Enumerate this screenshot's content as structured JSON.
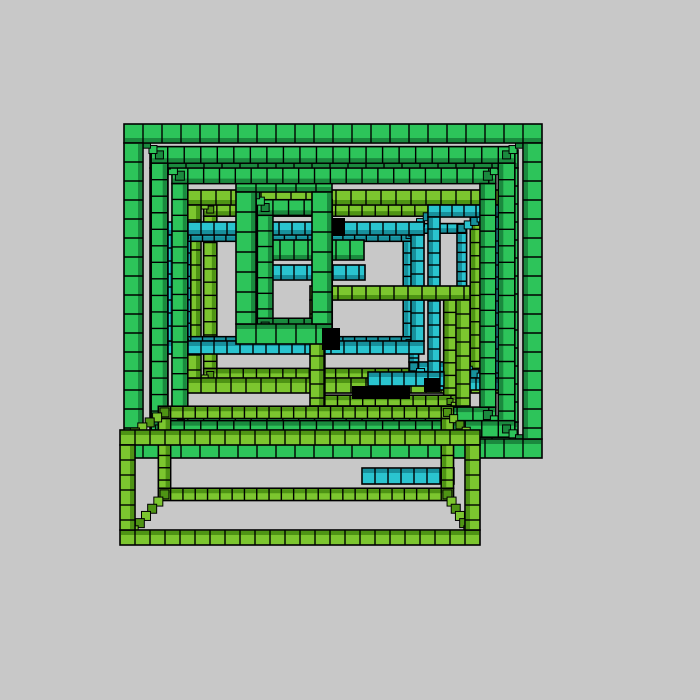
{
  "canvas": {
    "width": 700,
    "height": 700,
    "background": "#c8c8c8",
    "outline": "#000000"
  },
  "projection": {
    "vanishing_point": [
      333,
      298
    ]
  },
  "palette": {
    "green": {
      "fill": "#2dc45a",
      "dark": "#1a8a3e"
    },
    "lime": {
      "fill": "#7cc62f",
      "dark": "#4e9414"
    },
    "cyan": {
      "fill": "#2ac4cf",
      "dark": "#17909c"
    },
    "shadow": "#000000"
  },
  "scene": {
    "description": "nested voxel wireframe cubes",
    "items": [
      {
        "type": "frame",
        "name": "lime-cube-large",
        "color": "lime",
        "front": [
          186,
          190,
          318,
          203
        ],
        "k": 0.88,
        "block": 15
      },
      {
        "type": "frame",
        "name": "cyan-cube-right",
        "color": "cyan",
        "front": [
          428,
          205,
          72,
          185
        ],
        "k": 0.8,
        "block": 12
      },
      {
        "type": "frame",
        "name": "cyan-cube-left",
        "color": "cyan",
        "front": [
          162,
          222,
          262,
          132
        ],
        "k": 0.9,
        "block": 13
      },
      {
        "type": "frame",
        "name": "lime-cube-right",
        "color": "lime",
        "front": [
          310,
          286,
          160,
          134
        ],
        "k": 0.9,
        "block": 14
      },
      {
        "type": "beam",
        "name": "green-beam-upper",
        "color": "green",
        "rect": [
          252,
          240,
          112,
          20
        ],
        "block": 14
      },
      {
        "type": "beam",
        "name": "cyan-beam-mid",
        "color": "cyan",
        "rect": [
          255,
          265,
          110,
          15
        ],
        "block": 13
      },
      {
        "type": "beam",
        "name": "cyan-beam-lower",
        "color": "cyan",
        "rect": [
          368,
          372,
          76,
          14
        ],
        "block": 12
      },
      {
        "type": "frame",
        "name": "green-cube-center",
        "color": "green",
        "front": [
          236,
          172,
          96,
          172
        ],
        "k": 0.78,
        "block": 20
      },
      {
        "type": "shadow",
        "name": "shadow-center",
        "rect": [
          322,
          328,
          18,
          22
        ]
      },
      {
        "type": "shadow",
        "name": "shadow-lower-left",
        "rect": [
          352,
          386,
          58,
          13
        ]
      },
      {
        "type": "shadow",
        "name": "shadow-lower-right",
        "rect": [
          424,
          378,
          16,
          14
        ]
      },
      {
        "type": "shadow",
        "name": "shadow-upper",
        "rect": [
          333,
          218,
          12,
          18
        ]
      },
      {
        "type": "frame",
        "name": "green-cube-inner",
        "color": "green",
        "front": [
          150,
          150,
          368,
          290
        ],
        "k": 0.88,
        "block": 18
      },
      {
        "type": "frame",
        "name": "green-cube-outer",
        "color": "green",
        "front": [
          124,
          124,
          418,
          334
        ],
        "k": 0.87,
        "block": 19
      },
      {
        "type": "beam",
        "name": "cyan-beam-bottom",
        "color": "cyan",
        "rect": [
          362,
          468,
          92,
          16
        ],
        "block": 13
      },
      {
        "type": "frame",
        "name": "lime-box-bottom",
        "color": "lime",
        "front": [
          120,
          430,
          360,
          115
        ],
        "k": 0.82,
        "block": 15
      }
    ]
  }
}
